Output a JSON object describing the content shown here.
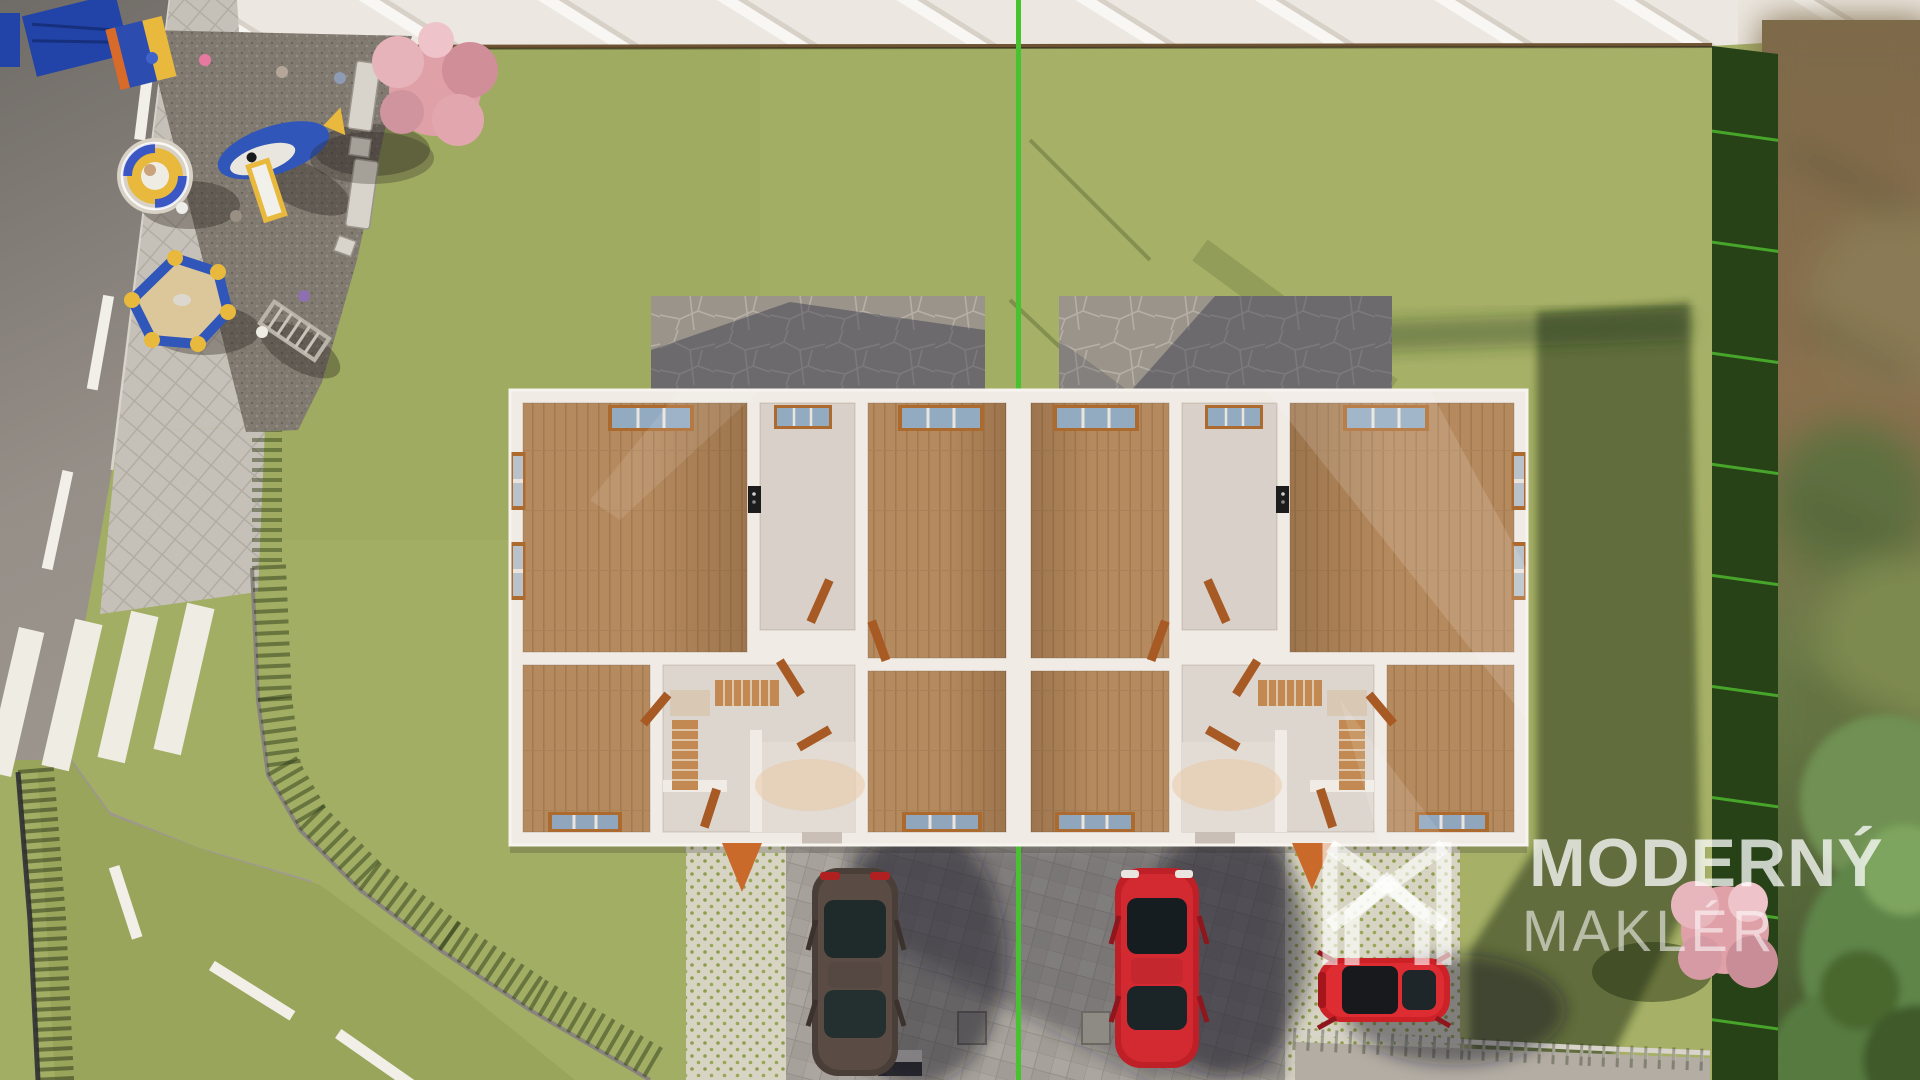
{
  "watermark": {
    "brand_line1": "MODERNÝ",
    "brand_line2": "MAKLÉR",
    "logo_icon": "house-monogram-m-icon"
  },
  "scene_objects": [
    "lawn",
    "neighbor-roof",
    "property-boundary-line",
    "duplex-floorplan-building",
    "stone-walkway-left",
    "stone-walkway-right",
    "asphalt-road",
    "pedestrian-crossing",
    "sidewalk",
    "fence-curved",
    "playground-gravel",
    "playground-carousel",
    "playground-whale-slide",
    "playground-sandbox",
    "playground-canopy",
    "benches",
    "blossom-tree-playground",
    "blossom-tree-garden",
    "hedge-strip",
    "garden-trees",
    "driveway-pavers",
    "grass-pavers",
    "car-dark",
    "car-red",
    "car-red-hatchback",
    "utility-boxes",
    "railing-fence-bottom"
  ],
  "palette": {
    "lawn": "#a2ae63",
    "lawn_shadow": "#44581f",
    "roof": "#efebe4",
    "roof_eave": "#6e5332",
    "boundary_line": "#46c32f",
    "wall_white": "#f0ebe5",
    "wood_floor": "#b68a5f",
    "light_floor": "#dcd5ce",
    "window_frame": "#ad6a2e",
    "window_glass": "#97acbf",
    "door": "#a85a24",
    "road": "#8f8a84",
    "road_marking": "#f2efe8",
    "gravel": "#8e877c",
    "driveway": "#a6a19a",
    "grass_paver": "#d8d4c3",
    "flagstone": "#9a948b",
    "hedge": "#32511f",
    "car_dark": "#4a3e38",
    "car_red": "#bf1f26",
    "blossom_pink": "#dfa0a8",
    "watermark_white": "rgba(255,255,255,0.7)"
  }
}
